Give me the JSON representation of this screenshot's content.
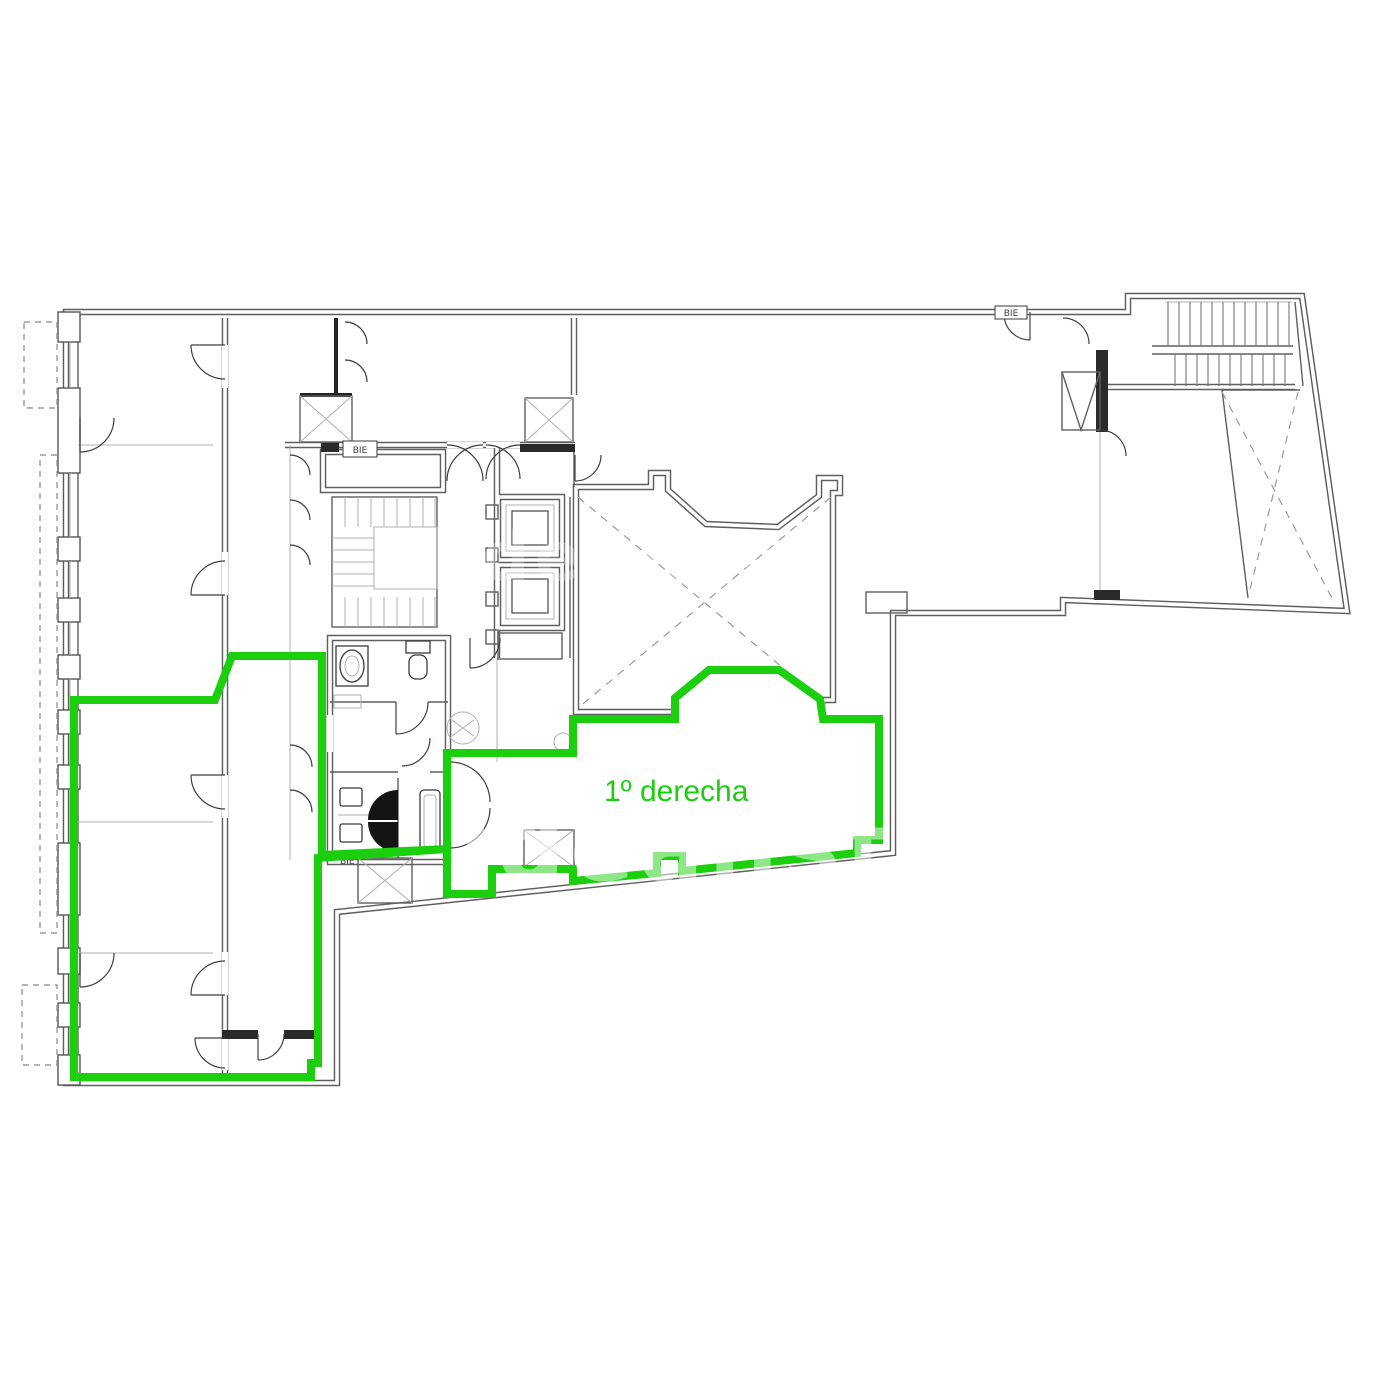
{
  "plan": {
    "title": "floor-plan",
    "unit_label": "1º derecha",
    "highlight_color": "#1ccf0e",
    "wall_color": "#5f5f5f",
    "background_color": "#ffffff",
    "equipment_labels": {
      "bie": "BIE"
    },
    "watermark": {
      "text": "idealista"
    }
  }
}
